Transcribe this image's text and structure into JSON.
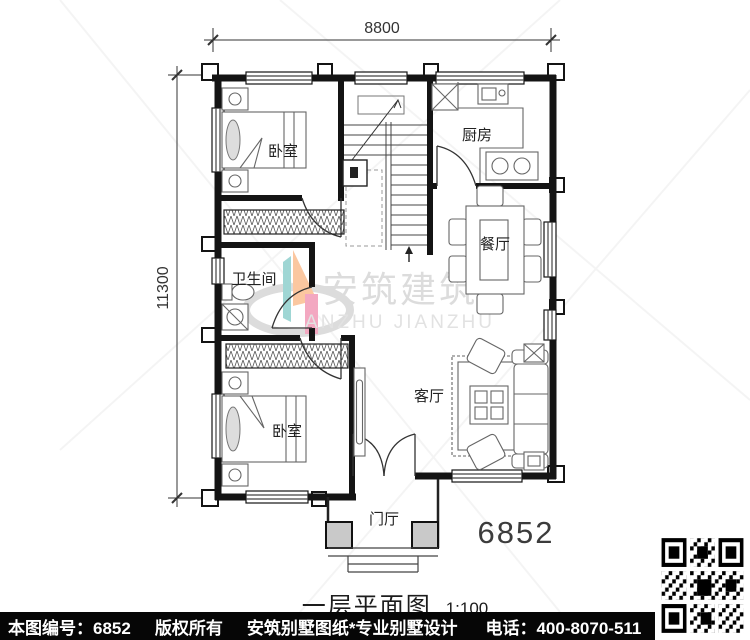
{
  "plan_number": "6852",
  "dimensions": {
    "width": "8800",
    "height": "11300"
  },
  "rooms": {
    "bedroom_top": "卧室",
    "kitchen": "厨房",
    "dining": "餐厅",
    "bathroom": "卫生间",
    "living": "客厅",
    "bedroom_bottom": "卧室",
    "foyer": "门厅"
  },
  "watermark": {
    "cn": "安筑建筑",
    "en": "ANZHU JIANZHU"
  },
  "title": {
    "name": "一层平面图",
    "scale": "1:100"
  },
  "footer": {
    "number_label": "本图编号：6852",
    "copyright": "版权所有",
    "brand": "安筑别墅图纸*专业别墅设计",
    "phone": "电话：400-8070-511",
    "qr_hint": "扫码看图"
  },
  "colors": {
    "wall": "#141414",
    "logo_orange": "#fbc7a0",
    "logo_pink": "#f3a8c1",
    "logo_teal": "#9fd6d4",
    "footer_bg": "#060606"
  }
}
